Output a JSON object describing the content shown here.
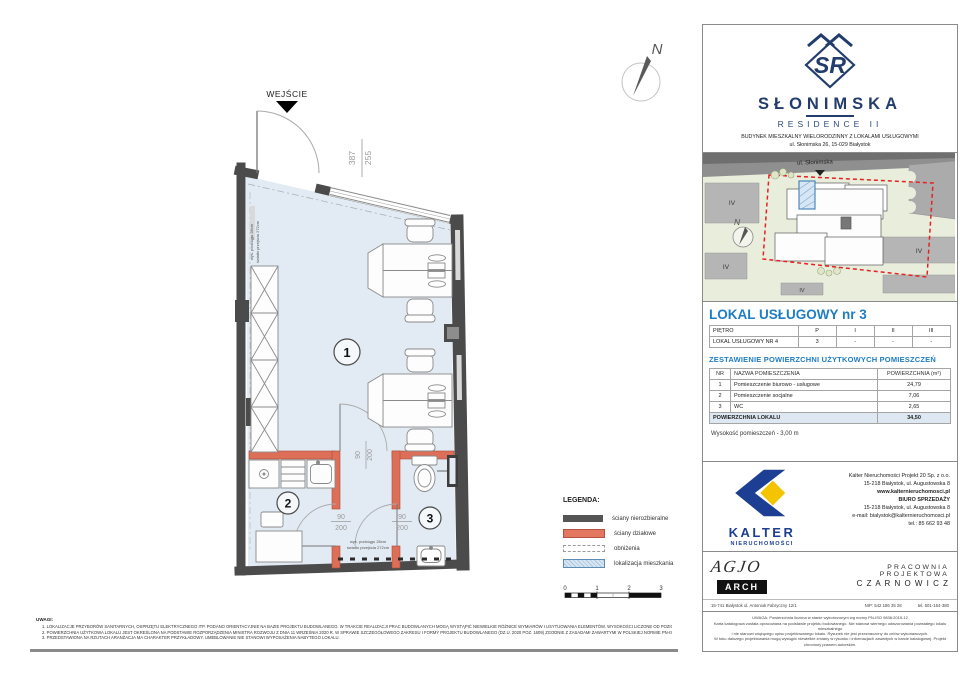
{
  "branding": {
    "monogram": "SR",
    "name": "SŁONIMSKA",
    "subname": "RESIDENCE II",
    "desc": "BUDYNEK MIESZKALNY WIELORODZINNY Z LOKALAMI USŁUGOWYMI",
    "address": "ul. Słonimska 26, 15-029 Białystok"
  },
  "site_plan": {
    "street": "ul. Słonimska",
    "north": "N",
    "building_label": "IV"
  },
  "unit": {
    "title": "LOKAL USŁUGOWY  nr 3"
  },
  "floor_table": {
    "header": [
      "PIĘTRO",
      "P",
      "I",
      "II",
      "III"
    ],
    "row": [
      "LOKAL USŁUGOWY NR 4",
      "3",
      "-",
      "-",
      "-"
    ]
  },
  "area_section": {
    "title": "ZESTAWIENIE POWIERZCHNI UŻYTKOWYCH POMIESZCZEŃ",
    "headers": [
      "NR",
      "NAZWA POMIESZCZENIA",
      "POWIERZCHNIA (m²)"
    ],
    "rows": [
      {
        "nr": "1",
        "name": "Pomieszczenie biurowo - usługowe",
        "area": "24,79"
      },
      {
        "nr": "2",
        "name": "Pomieszczenie socjalne",
        "area": "7,06"
      },
      {
        "nr": "3",
        "name": "WC",
        "area": "2,65"
      }
    ],
    "total_label": "POWIERZCHNIA LOKALU",
    "total_value": "34,50",
    "height_note": "Wysokość pomieszczeń - 3,00 m"
  },
  "plan": {
    "entrance": "WEJŚCIE",
    "north": "N",
    "win_num": "387",
    "win_den": "255",
    "door_num": "90",
    "door_den": "200",
    "room1": "1",
    "room2": "2",
    "room3": "3",
    "note1": "wys. podciągu 28cm",
    "note2": "światło przejścia 272cm"
  },
  "legend": {
    "title": "LEGENDA:",
    "items": [
      {
        "label": "ściany nierozbieralne"
      },
      {
        "label": "ściany działowe"
      },
      {
        "label": "obniżenia"
      },
      {
        "label": "lokalizacja mieszkania"
      }
    ],
    "scale": [
      "0",
      "1",
      "2",
      "3"
    ]
  },
  "notes": {
    "title": "UWAGI:",
    "items": [
      "1.   LOKALIZACJE PRZYBORÓW SANITARNYCH, OSPRZĘTU ELEKTRYCZNEGO ITP. PODANO ORIENTACYJNIE NA BAZIE PROJEKTU BUDOWLANEGO. W TRAKCIE REALIZACJI PRAC BUDOWLANYCH MOGĄ WYSTĄPIĆ NIEWIELKIE RÓŻNICE WYMIARÓW I USYTUOWANIA ELEMENTÓW. WYSOKOŚCI LICZONE OD POZIOMU DOCELOWEGO WYKOŃCZENIA PODŁOGI.",
      "2.   POWIERZCHNIA UŻYTKOWA LOKALU JEST OKREŚLONA NA PODSTAWIE ROZPORZĄDZENIA MINISTRA ROZWOJU Z DNIA 11 WRZEŚNIA 2020 R. W SPRAWIE SZCZEGÓŁOWEGO ZAKRESU I FORMY PROJEKTU BUDOWLANEGO (DZ.U. 2020 POZ. 1609) ZGODNIE Z ZASADAMI ZAWARTYMI W POLSKIEJ NORMIE PN-ISO 9836:2015-12",
      "3.   PRZEDSTAWIONA NA RZUTACH ARANŻACJA MA CHARAKTER PRZYKŁADOWY. UMEBLOWANIE NIE STANOWI WYPOSAŻENIA NABYTEGO LOKALU."
    ]
  },
  "kalter": {
    "name": "KALTER",
    "sub": "NIERUCHOMOŚCI",
    "lines": [
      "Kalter Nieruchomości Projekt 20  Sp. z o.o.",
      "15-218 Białystok, ul. Augustowska 8",
      "www.kalternieruchomosci.pl",
      "BIURO SPRZEDAŻY",
      "15-218 Białystok, ul. Augustowska 8",
      "e-mail: bialystok@kalternieruchomosci.pl",
      "tel.: 85 662 93 48"
    ]
  },
  "agjo": {
    "script": "AGJO",
    "arch": "ARCH",
    "address": "15-741 Białystok    ul. Antoniuk Fabryczny  12/1",
    "studio1": "PRACOWNIA  PROJEKTOWA",
    "studio2": "C Z A R N O W I C Z",
    "nip": "NIP:  542 186 35 28",
    "tel": "tel. 501-154-380"
  },
  "disclaimer": [
    "UWAGA:  Powierzchnia liczona w stanie wykończonym wg normy PN-ISO 9836:2015-12",
    "Karta katalogowa została opracowana na podstawie projektu budowlanego.  Nie stanowi wiernego odwzorowania powstałego lokalu mieszkalnego",
    "i nie stanowi wiążącego opisu projektowanego lokalu. Rysunek nie jest przeznaczony do celów wykonawczych.",
    "W toku dalszego projektowania mogą wystąpić niewielkie zmiany w rysunku i informacjach zawartych w karcie katalogowej. Projekt chroniony prawem autorskim."
  ],
  "colors": {
    "navy": "#223d6b",
    "blue_header": "#1e7dc4",
    "wall_dark": "#4b4b4b",
    "wall_red": "#dd6f58",
    "room_fill": "#e2ebf3",
    "map_green": "#e9eddc",
    "red_dashed": "#e32222",
    "kalter_blue": "#1d3f93",
    "kalter_yellow": "#f4c400"
  }
}
